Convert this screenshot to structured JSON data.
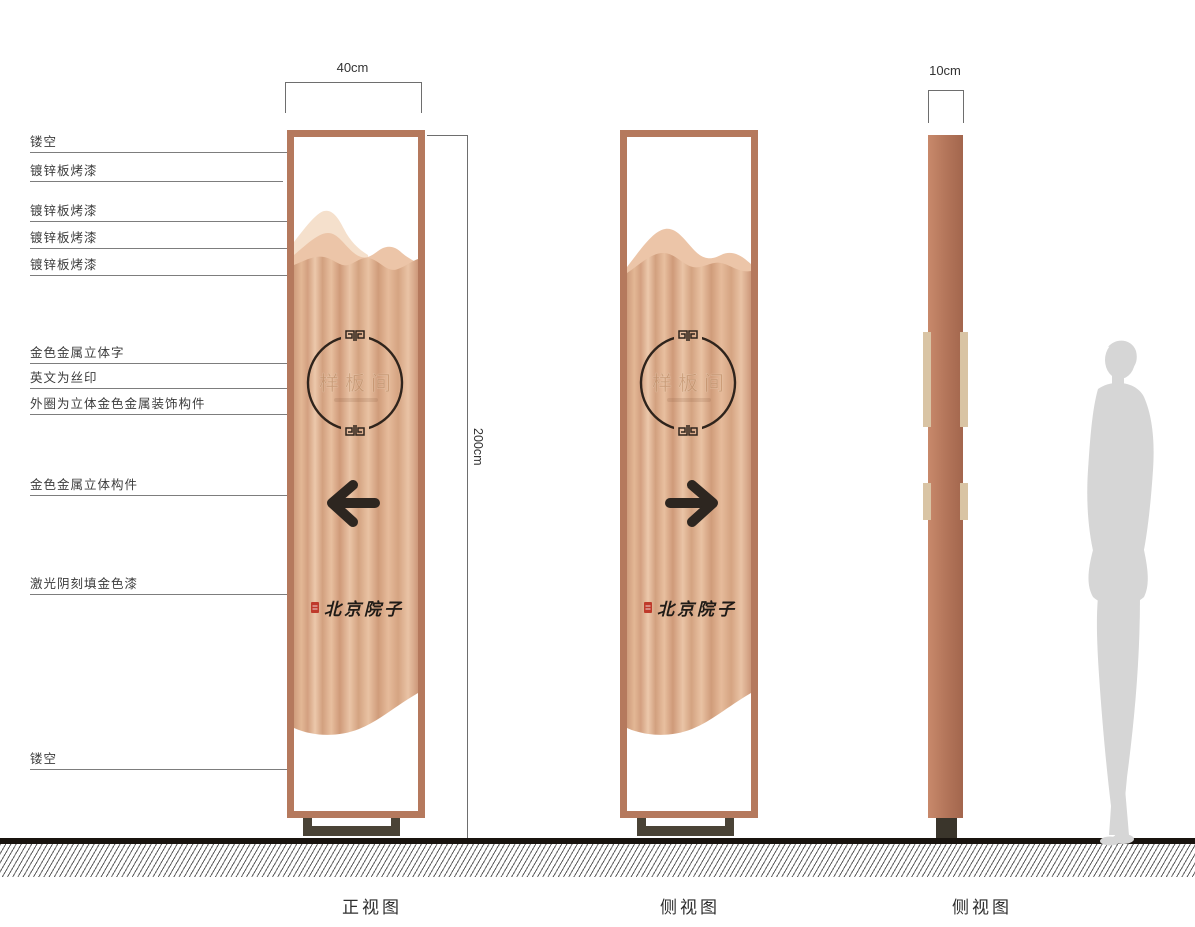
{
  "dimensions": {
    "front_width": "40cm",
    "height": "200cm",
    "side_depth": "10cm"
  },
  "callouts": {
    "items": [
      {
        "label": "镂空"
      },
      {
        "label": "镀锌板烤漆"
      },
      {
        "label": "镀锌板烤漆"
      },
      {
        "label": "镀锌板烤漆"
      },
      {
        "label": "镀锌板烤漆"
      },
      {
        "label": "金色金属立体字"
      },
      {
        "label": "英文为丝印"
      },
      {
        "label": "外圈为立体金色金属装饰构件"
      },
      {
        "label": "金色金属立体构件"
      },
      {
        "label": "激光阴刻填金色漆"
      },
      {
        "label": "镂空"
      }
    ]
  },
  "totem": {
    "circle_text": "样板间",
    "brand_text": "北京院子"
  },
  "views": {
    "front_label": "正视图",
    "side_label": "侧视图",
    "profile_label": "侧视图"
  },
  "colors": {
    "frame_copper": "#b5795d",
    "panel_light": "#f5e0cc",
    "panel_mid": "#ecc5a8",
    "panel_brushed_base": "#d8a685",
    "ink_dark": "#2d241c",
    "seal_red": "#bf3a2b",
    "base_olive": "#4a4336",
    "gold_strip": "#d9c4a4",
    "silhouette_gray": "#d6d6d6"
  }
}
